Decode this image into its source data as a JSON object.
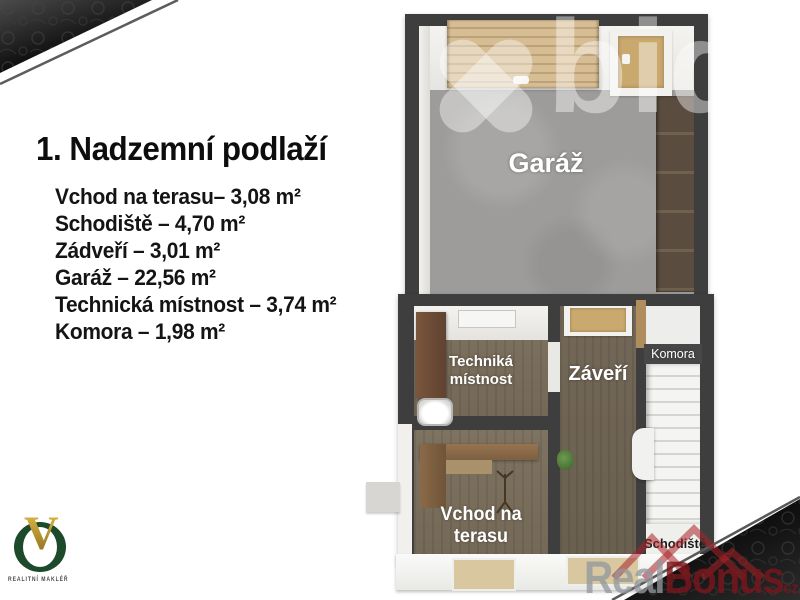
{
  "slide": {
    "title": "1. Nadzemní podlaží",
    "areas": [
      "Vchod na terasu– 3,08 m²",
      "Schodiště – 4,70 m²",
      "Zádveří – 3,01 m²",
      "Garáž – 22,56 m²",
      "Technická místnost – 3,74 m²",
      "Komora – 1,98 m²"
    ]
  },
  "floor_plan": {
    "room_labels": {
      "garage": "Garáž",
      "technical_room": [
        "Techniká",
        "místnost"
      ],
      "entry_hall": "Záveří",
      "pantry": "Komora",
      "staircase": "Schodiště",
      "terrace_entrance": "Vchod na terasu"
    }
  },
  "branding": {
    "agency": {
      "monogram": "V",
      "caption": "REALITNÍ MAKLÉŘ"
    },
    "watermark_bid": "bid",
    "watermark_realbonus": {
      "part1": "Real",
      "part2": "Bonus",
      "tld": "cz"
    }
  },
  "colors": {
    "agency_green": "#1d4a2a",
    "agency_gold": "#c9a227",
    "realbonus_red": "#8a1f24",
    "wall_dark": "#3e3e3e",
    "wood_floor": "#7b6f5e",
    "concrete_floor": "#9d9c9a"
  }
}
